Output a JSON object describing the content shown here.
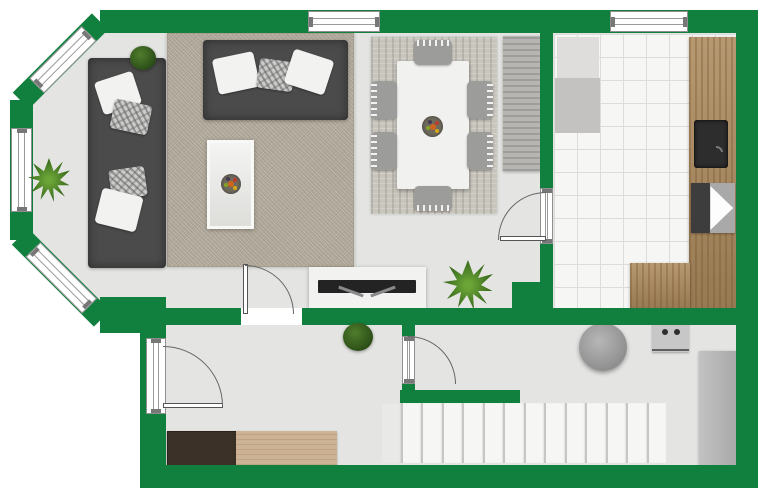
{
  "meta": {
    "canvas_width": 763,
    "canvas_height": 500,
    "visible_text": []
  },
  "palette": {
    "wall": "#11803e",
    "floor": "#e4e5e3",
    "tile": "#f6f6f4",
    "rugA": "#b5ad9e",
    "rugB": "#c8c5bc",
    "sofa": "#4b4b4b",
    "wood": "#ac8a5e"
  },
  "elements": [
    {
      "name": "main-floor",
      "cls": "floor-main",
      "x": 0,
      "y": 0,
      "w": 763,
      "h": 500
    },
    {
      "name": "hallway-floor",
      "cls": "floor",
      "x": 165,
      "y": 323,
      "w": 573,
      "h": 145
    },
    {
      "name": "kitchen-tile-floor",
      "cls": "tile",
      "x": 553,
      "y": 33,
      "w": 185,
      "h": 277
    },
    {
      "name": "living-room-rug",
      "cls": "rug-a",
      "x": 167,
      "y": 33,
      "w": 187,
      "h": 234
    },
    {
      "name": "dining-area-rug",
      "cls": "rug-b",
      "x": 371,
      "y": 37,
      "w": 126,
      "h": 177
    },
    {
      "name": "sofa-left",
      "cls": "sofa",
      "x": 88,
      "y": 58,
      "w": 78,
      "h": 210
    },
    {
      "name": "sofa-top",
      "cls": "sofa",
      "x": 203,
      "y": 40,
      "w": 145,
      "h": 80
    },
    {
      "name": "throw-pillow-white-1",
      "cls": "pillow",
      "x": 98,
      "y": 76,
      "w": 40,
      "h": 34,
      "rot": -18,
      "o": "c"
    },
    {
      "name": "throw-pillow-pattern-1",
      "cls": "pillow-pat",
      "x": 112,
      "y": 102,
      "w": 38,
      "h": 30,
      "rot": 12,
      "o": "c"
    },
    {
      "name": "throw-pillow-pattern-2",
      "cls": "pillow-pat",
      "x": 110,
      "y": 168,
      "w": 36,
      "h": 30,
      "rot": -8,
      "o": "c"
    },
    {
      "name": "throw-pillow-white-2",
      "cls": "pillow",
      "x": 98,
      "y": 192,
      "w": 42,
      "h": 36,
      "rot": 14,
      "o": "c"
    },
    {
      "name": "throw-pillow-white-3",
      "cls": "pillow",
      "x": 215,
      "y": 55,
      "w": 42,
      "h": 36,
      "rot": -12,
      "o": "c"
    },
    {
      "name": "throw-pillow-pattern-3",
      "cls": "pillow-pat",
      "x": 258,
      "y": 60,
      "w": 36,
      "h": 30,
      "rot": 8,
      "o": "c"
    },
    {
      "name": "throw-pillow-white-4",
      "cls": "pillow",
      "x": 288,
      "y": 54,
      "w": 42,
      "h": 36,
      "rot": 18,
      "o": "c"
    },
    {
      "name": "coffee-table",
      "cls": "ctable",
      "x": 207,
      "y": 140,
      "w": 47,
      "h": 89
    },
    {
      "name": "fruit-bowl-coffee-table",
      "cls": "bowl",
      "x": 221,
      "y": 174,
      "w": 20,
      "h": 20
    },
    {
      "name": "dining-table",
      "cls": "table",
      "x": 397,
      "y": 61,
      "w": 72,
      "h": 128
    },
    {
      "name": "fruit-bowl-dining-table",
      "cls": "bowl",
      "x": 422,
      "y": 116,
      "w": 21,
      "h": 21
    },
    {
      "name": "dining-chair-north",
      "cls": "chair side-n",
      "x": 414,
      "y": 40,
      "w": 38,
      "h": 25
    },
    {
      "name": "dining-chair-south",
      "cls": "chair side-s",
      "x": 414,
      "y": 186,
      "w": 38,
      "h": 25
    },
    {
      "name": "dining-chair-west-1",
      "cls": "chair side-w",
      "x": 371,
      "y": 81,
      "w": 26,
      "h": 38
    },
    {
      "name": "dining-chair-west-2",
      "cls": "chair side-w",
      "x": 371,
      "y": 132,
      "w": 26,
      "h": 38
    },
    {
      "name": "dining-chair-east-1",
      "cls": "chair side-e",
      "x": 467,
      "y": 81,
      "w": 26,
      "h": 38
    },
    {
      "name": "dining-chair-east-2",
      "cls": "chair side-e",
      "x": 467,
      "y": 132,
      "w": 26,
      "h": 38
    },
    {
      "name": "dining-sideboard",
      "cls": "sb-gray",
      "x": 503,
      "y": 36,
      "w": 38,
      "h": 135
    },
    {
      "name": "fridge",
      "cls": "box",
      "x": 557,
      "y": 37,
      "w": 42,
      "h": 41,
      "bg": "#dedddb"
    },
    {
      "name": "kitchen-appliance",
      "cls": "box",
      "x": 555,
      "y": 78,
      "w": 45,
      "h": 55,
      "bg": "#c3c2c0"
    },
    {
      "name": "kitchen-counter",
      "cls": "wood",
      "x": 689,
      "y": 37,
      "w": 49,
      "h": 271
    },
    {
      "name": "kitchen-counter-return",
      "cls": "wood",
      "x": 630,
      "y": 263,
      "w": 60,
      "h": 45
    },
    {
      "name": "kitchen-sink",
      "cls": "sink",
      "x": 694,
      "y": 120,
      "w": 34,
      "h": 48
    },
    {
      "name": "oven",
      "cls": "oven",
      "x": 691,
      "y": 183,
      "w": 44,
      "h": 50
    },
    {
      "name": "tv-console",
      "cls": "console",
      "x": 309,
      "y": 267,
      "w": 117,
      "h": 41
    },
    {
      "name": "tv",
      "cls": "tv",
      "x": 318,
      "y": 280,
      "w": 98,
      "h": 13
    },
    {
      "name": "entry-bench",
      "cls": "bench",
      "x": 167,
      "y": 431,
      "w": 71,
      "h": 36
    },
    {
      "name": "entry-sideboard",
      "cls": "sb-tan",
      "x": 236,
      "y": 431,
      "w": 101,
      "h": 34
    },
    {
      "name": "pouf",
      "cls": "pouf",
      "x": 579,
      "y": 323,
      "w": 48,
      "h": 48
    },
    {
      "name": "washing-machine",
      "cls": "washer",
      "x": 652,
      "y": 322,
      "w": 37,
      "h": 30
    },
    {
      "name": "hall-cabinet",
      "cls": "cab",
      "x": 699,
      "y": 351,
      "w": 37,
      "h": 114
    },
    {
      "name": "staircase",
      "cls": "stairs",
      "x": 382,
      "y": 403,
      "w": 285,
      "h": 60,
      "n": 14
    },
    {
      "name": "wall-top",
      "cls": "wall",
      "x": 100,
      "y": 10,
      "w": 640,
      "h": 23
    },
    {
      "name": "wall-right",
      "cls": "wall",
      "x": 736,
      "y": 10,
      "w": 22,
      "h": 478
    },
    {
      "name": "wall-bottom",
      "cls": "wall",
      "x": 140,
      "y": 465,
      "w": 618,
      "h": 23
    },
    {
      "name": "wall-hall-left",
      "cls": "wall",
      "x": 140,
      "y": 325,
      "w": 26,
      "h": 144
    },
    {
      "name": "wall-bay-base",
      "cls": "wall",
      "x": 100,
      "y": 297,
      "w": 66,
      "h": 36
    },
    {
      "name": "wall-hall-top",
      "cls": "wall",
      "x": 165,
      "y": 308,
      "w": 573,
      "h": 17
    },
    {
      "name": "wall-kitchen-west",
      "cls": "wall",
      "x": 540,
      "y": 28,
      "w": 13,
      "h": 282
    },
    {
      "name": "wall-kitchen-pillar",
      "cls": "wall",
      "x": 512,
      "y": 282,
      "w": 41,
      "h": 27
    },
    {
      "name": "wall-stairs",
      "cls": "wall",
      "x": 400,
      "y": 390,
      "w": 120,
      "h": 13
    },
    {
      "name": "wall-hall-divider-stub-upper",
      "cls": "wall",
      "x": 402,
      "y": 325,
      "w": 13,
      "h": 11
    },
    {
      "name": "wall-hall-divider-stub-lower",
      "cls": "wall",
      "x": 402,
      "y": 384,
      "w": 13,
      "h": 8
    },
    {
      "name": "wall-bay-upper-diagonal",
      "cls": "wall",
      "x": 100,
      "y": 10,
      "w": 112,
      "h": 23,
      "rot": 135
    },
    {
      "name": "wall-bay-lower-diagonal",
      "cls": "wall",
      "x": 20,
      "y": 225,
      "w": 116,
      "h": 23,
      "rot": 45
    },
    {
      "name": "wall-bay-left",
      "cls": "wall",
      "x": 10,
      "y": 100,
      "w": 23,
      "h": 140
    },
    {
      "name": "window-top-living",
      "cls": "win win-h",
      "x": 308,
      "y": 11,
      "w": 72,
      "h": 21
    },
    {
      "name": "window-top-kitchen",
      "cls": "win win-h",
      "x": 610,
      "y": 11,
      "w": 78,
      "h": 21
    },
    {
      "name": "window-bay-upper",
      "cls": "win win-h",
      "x": 89,
      "y": 23,
      "w": 74,
      "h": 21,
      "rot": 135
    },
    {
      "name": "window-bay-left",
      "cls": "win win-v",
      "x": 11,
      "y": 128,
      "w": 21,
      "h": 84
    },
    {
      "name": "window-bay-lower",
      "cls": "win win-h",
      "x": 33,
      "y": 239,
      "w": 80,
      "h": 21,
      "rot": 45
    },
    {
      "name": "living-room-door-opening",
      "cls": "gap",
      "x": 241,
      "y": 308,
      "w": 61,
      "h": 17
    },
    {
      "name": "living-room-door-leaf",
      "cls": "leaf",
      "x": 243,
      "y": 264,
      "w": 5,
      "h": 50
    },
    {
      "name": "living-room-door-swing-arc",
      "cls": "arc arc-ne",
      "x": 196,
      "y": 265,
      "w": 98,
      "h": 98
    },
    {
      "name": "entry-door-frame",
      "cls": "win win-v",
      "x": 146,
      "y": 338,
      "w": 20,
      "h": 76
    },
    {
      "name": "entry-door-leaf",
      "cls": "leaf",
      "x": 163,
      "y": 403,
      "w": 60,
      "h": 5
    },
    {
      "name": "entry-door-swing-arc",
      "cls": "arc arc-ne",
      "x": 103,
      "y": 346,
      "w": 120,
      "h": 120
    },
    {
      "name": "hall-door-frame",
      "cls": "win win-v",
      "x": 402,
      "y": 336,
      "w": 13,
      "h": 48
    },
    {
      "name": "hall-door-swing-arc",
      "cls": "arc arc-ne",
      "x": 360,
      "y": 336,
      "w": 96,
      "h": 96
    },
    {
      "name": "dining-kitchen-door-frame",
      "cls": "win win-v",
      "x": 540,
      "y": 188,
      "w": 13,
      "h": 56
    },
    {
      "name": "dining-kitchen-door-leaf",
      "cls": "leaf",
      "x": 500,
      "y": 236,
      "w": 46,
      "h": 5
    },
    {
      "name": "dining-kitchen-door-swing-arc",
      "cls": "arc arc-nw",
      "x": 498,
      "y": 192,
      "w": 96,
      "h": 96
    },
    {
      "name": "potted-plant-living-top",
      "cls": "plant-round",
      "x": 130,
      "y": 46,
      "w": 26,
      "h": 24
    },
    {
      "name": "potted-plant-bay",
      "cls": "plant-spiky",
      "x": 28,
      "y": 158,
      "w": 42,
      "h": 44
    },
    {
      "name": "potted-plant-hallway",
      "cls": "plant-round",
      "x": 343,
      "y": 323,
      "w": 30,
      "h": 28
    },
    {
      "name": "potted-plant-dining",
      "cls": "plant-spiky",
      "x": 443,
      "y": 260,
      "w": 50,
      "h": 50
    }
  ]
}
